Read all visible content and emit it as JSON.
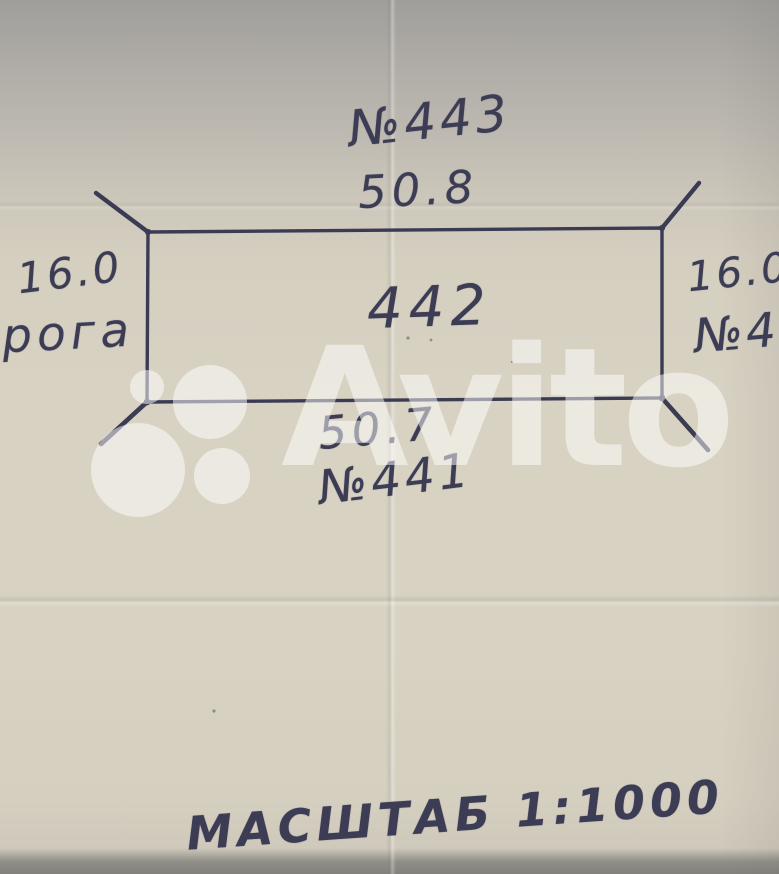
{
  "plot": {
    "number": "442",
    "north_neighbor": "№443",
    "north_side_length": "50.8",
    "south_side_length": "50.7",
    "south_neighbor": "№441",
    "west_side_length": "16.0",
    "west_label": "рога",
    "east_side_length": "16.0",
    "east_neighbor": "№4",
    "scale": "МАСШТАБ 1:1000"
  },
  "watermark": {
    "text": "Avito"
  },
  "colors": {
    "ink": "#3c3c55",
    "paper": "#d8d2c3",
    "paper_shadow": "#a09e9b",
    "watermark": "rgba(255,255,255,0.5)"
  }
}
